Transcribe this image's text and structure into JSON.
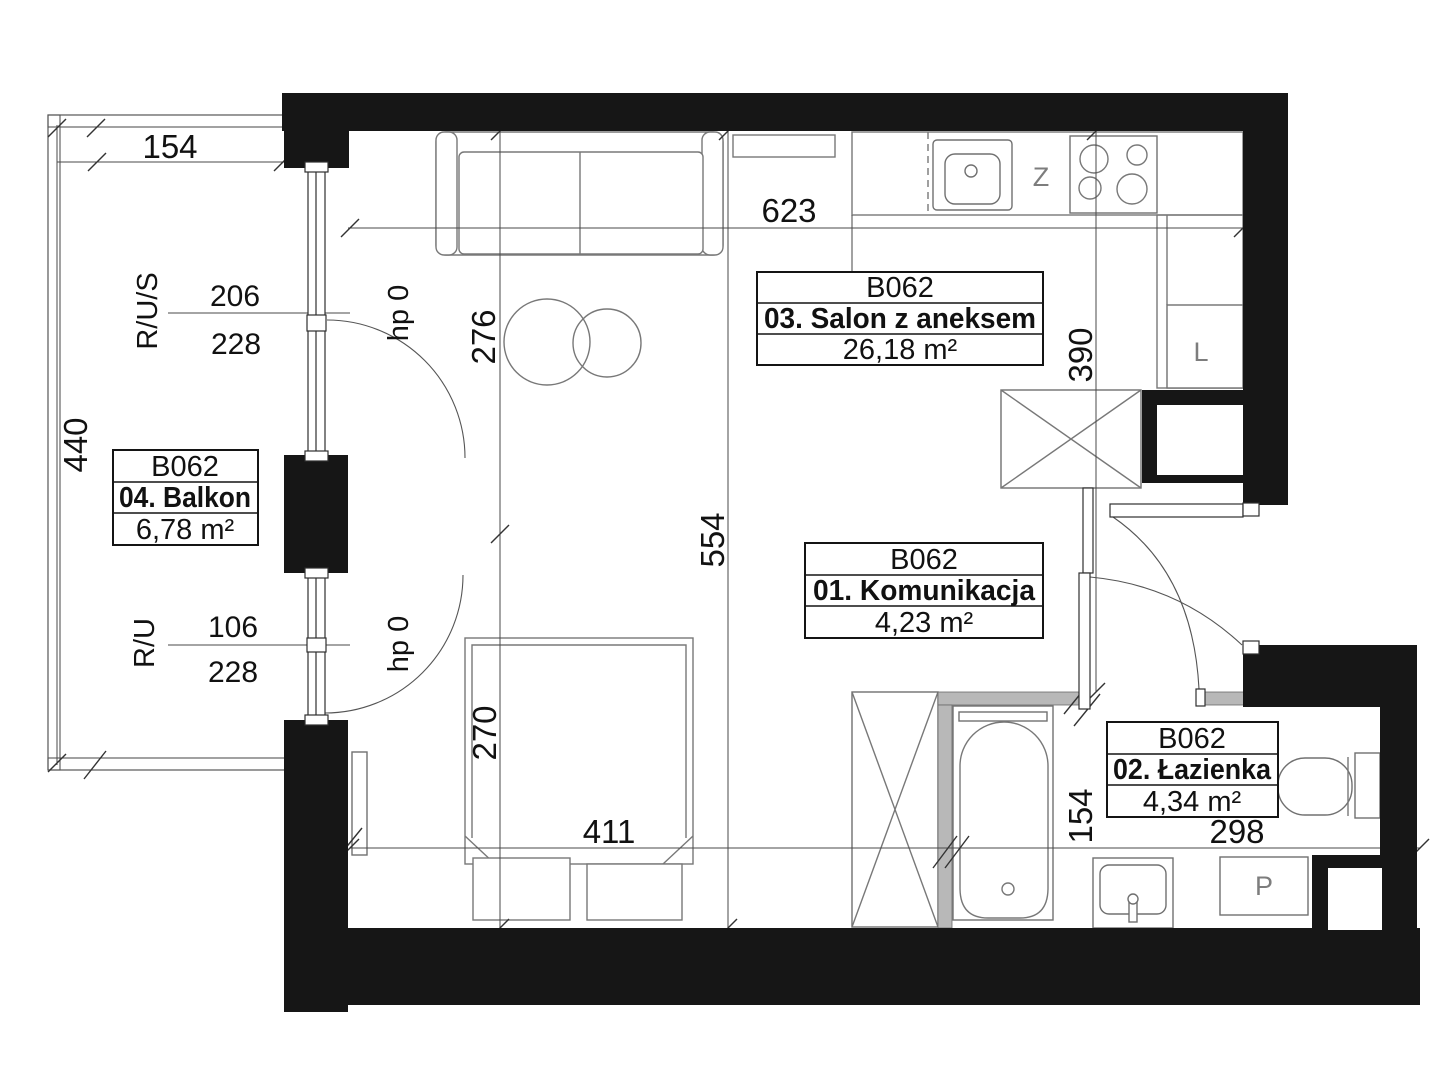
{
  "unit_id": "B062",
  "rooms": [
    {
      "id": "salon",
      "name": "03. Salon z aneksem",
      "area": "26,18 m²"
    },
    {
      "id": "komunikacja",
      "name": "01. Komunikacja",
      "area": "4,23 m²"
    },
    {
      "id": "lazienka",
      "name": "02. Łazienka",
      "area": "4,34 m²"
    },
    {
      "id": "balkon",
      "name": "04. Balkon",
      "area": "6,78 m²"
    }
  ],
  "dimensions": {
    "balcony_width": "154",
    "balcony_length": "440",
    "living_width": "623",
    "living_depth_total": "554",
    "living_depth_upper": "276",
    "sleeping_depth": "270",
    "sleeping_width": "411",
    "kitchen_wall": "390",
    "bathroom_width": "298",
    "bathroom_depth": "154",
    "window1_width": "206",
    "window1_height": "228",
    "window2_width": "106",
    "window2_height": "228"
  },
  "window_labels": {
    "window1_type": "R/U/S",
    "window2_type": "R/U",
    "window1_sill": "hp 0",
    "window2_sill": "hp 0"
  },
  "fixture_labels": {
    "dishwasher": "Z",
    "fridge": "L",
    "washing_machine": "P"
  },
  "colors": {
    "walls": "#161616",
    "partitions": "#b8b8b8",
    "lines": "#4a4a4a",
    "background": "#ffffff"
  }
}
